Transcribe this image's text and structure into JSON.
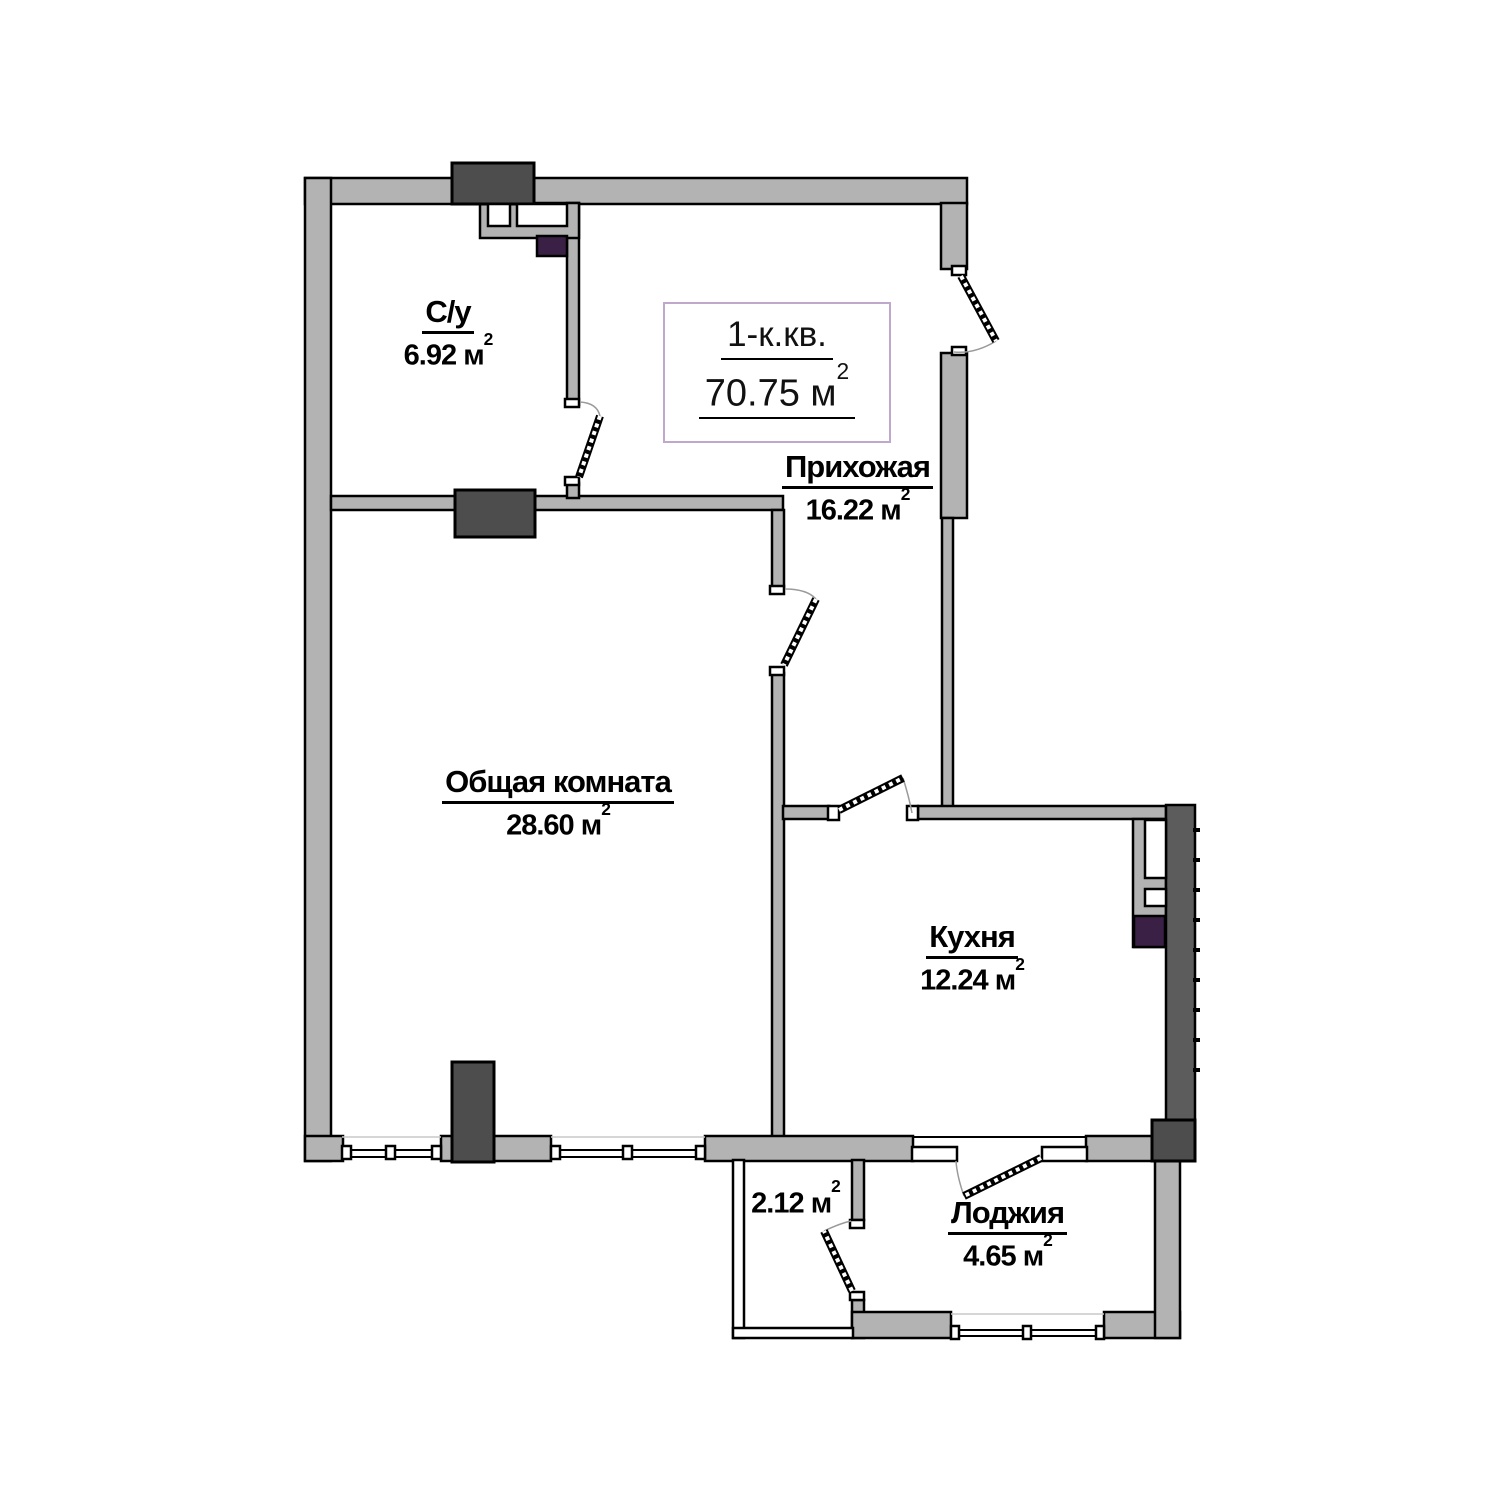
{
  "title_box": {
    "line1": "1-к.кв.",
    "total_area": "70.75",
    "unit": "м",
    "sup": "2"
  },
  "labels": {
    "unit": "м",
    "sup": "2"
  },
  "rooms": [
    {
      "id": "bathroom",
      "name": "С/у",
      "area": "6.92"
    },
    {
      "id": "hallway",
      "name": "Прихожая",
      "area": "16.22"
    },
    {
      "id": "living",
      "name": "Общая комната",
      "area": "28.60"
    },
    {
      "id": "kitchen",
      "name": "Кухня",
      "area": "12.24"
    },
    {
      "id": "balcony",
      "name": "",
      "area": "2.12"
    },
    {
      "id": "loggia",
      "name": "Лоджия",
      "area": "4.65"
    }
  ],
  "colors": {
    "wall-gray": "#b3b3b3",
    "dark-gray": "#4d4d4d",
    "outer-dark": "#5c5c5c",
    "purple": "#3b2045",
    "title-border": "#bfa8cc"
  }
}
